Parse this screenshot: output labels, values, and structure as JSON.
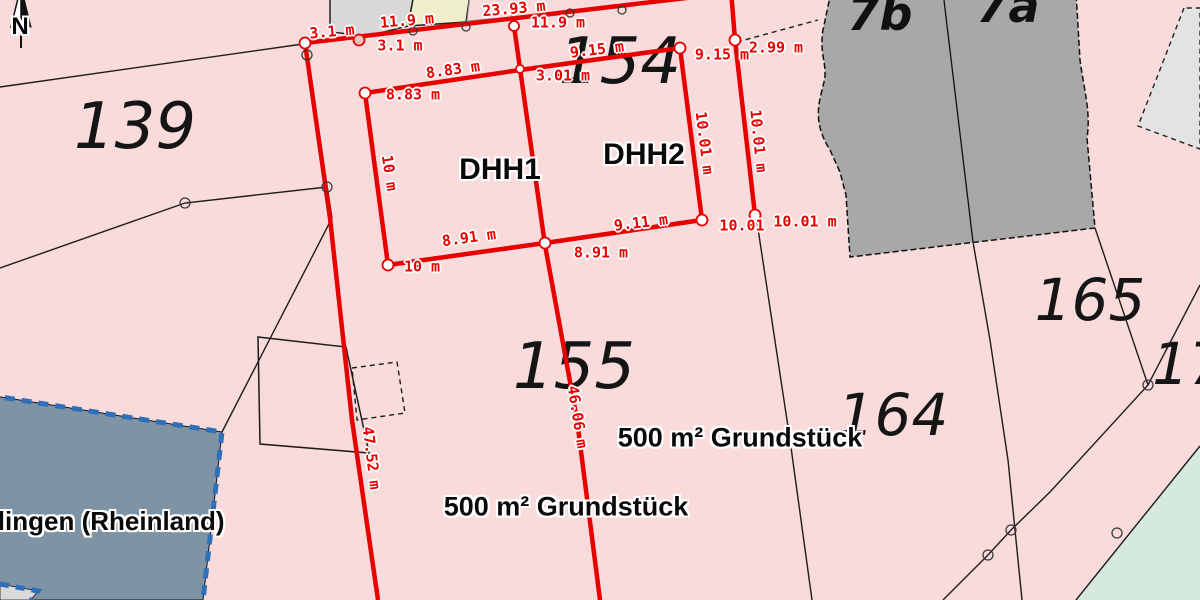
{
  "map": {
    "type_hint": "cadastral parcel map with red survey measurement overlay",
    "colors": {
      "background_pink": "#f9dbdb",
      "measure_red": "#e60000",
      "boundary_black": "#1c1c1c",
      "municipality_fill": "#7e93a4",
      "municipality_border_blue": "#2e6fba",
      "green_area": "#d5e9dc",
      "building_dark_gray": "#a8a8a8",
      "building_light_gray": "#d8d8d8",
      "building_pale_yellow": "#eeeecb"
    },
    "north_label": "N"
  },
  "parcels": [
    "139",
    "154",
    "155",
    "164",
    "165",
    "17"
  ],
  "house_numbers": [
    "7b",
    "7a"
  ],
  "plot_units": [
    "DHH1",
    "DHH2"
  ],
  "area_labels": [
    "500 m² Grundstück",
    "500 m² Grundstück"
  ],
  "municipality_label": "chlingen (Rheinland)",
  "measurements": [
    "3.1 m",
    "3.1 m",
    "11.9 m",
    "23.93 m",
    "11.9 m",
    "9.15 m",
    "9.15 m",
    "2.99 m",
    "8.83 m",
    "8.83 m",
    "3.01 m",
    "10 m",
    "8.91 m",
    "8.91 m",
    "9.11 m",
    "10 m",
    "10.01 m",
    "10.01 m",
    "10.01",
    "10.01 m",
    "46.06 m",
    "47.52 m"
  ]
}
